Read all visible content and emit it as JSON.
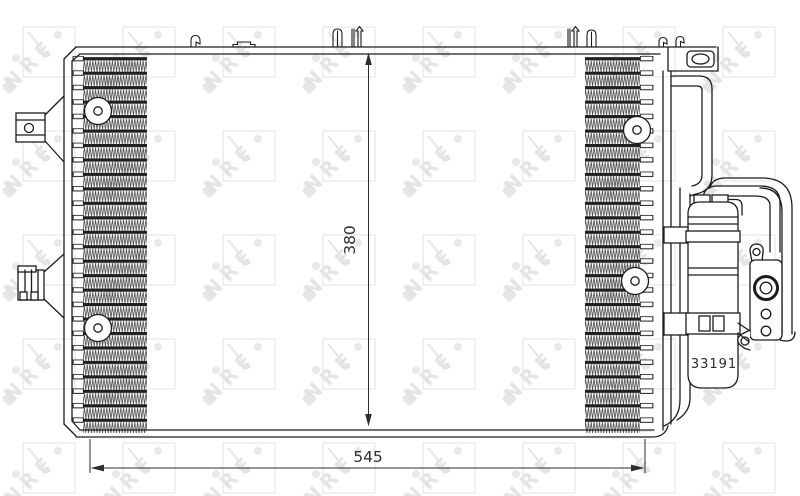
{
  "drawing": {
    "part_number": "33191",
    "height_dim": "380",
    "width_dim": "545"
  },
  "watermark": {
    "text": "NRF"
  },
  "colors": {
    "line": "#1c1c1c",
    "dimension": "#2e2e2e",
    "background": "#ffffff",
    "watermark_gray": "#e4e4e4"
  }
}
